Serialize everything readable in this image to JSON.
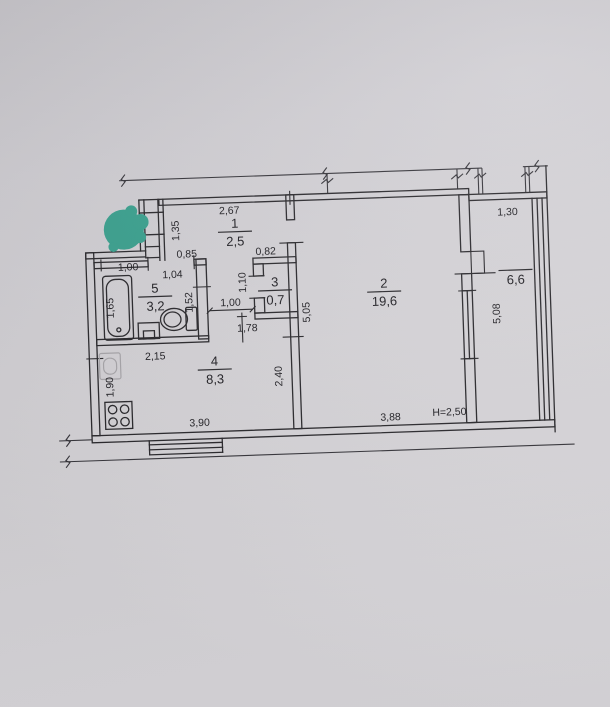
{
  "photo": {
    "background": "#d4d2d6",
    "line_color": "#29282c",
    "text_color": "#222126",
    "marker_color": "#3aa18f",
    "faint_color": "#a9a7ab"
  },
  "plan": {
    "rooms": [
      {
        "id": "hallway",
        "number": "1",
        "area": "2,5",
        "cx": 188,
        "line_y": 77
      },
      {
        "id": "living-room",
        "number": "2",
        "area": "19,6",
        "cx": 335,
        "line_y": 142
      },
      {
        "id": "wc",
        "number": "3",
        "area": "0,7",
        "cx": 226,
        "line_y": 137
      },
      {
        "id": "kitchen",
        "number": "4",
        "area": "8,3",
        "cx": 163,
        "line_y": 214
      },
      {
        "id": "bathroom",
        "number": "5",
        "area": "3,2",
        "cx": 106,
        "line_y": 139
      },
      {
        "id": "balcony",
        "number": "",
        "area": "6,6",
        "cx": 467,
        "line_y": 125,
        "overline": true
      }
    ],
    "dimensions": [
      {
        "text": "2,67",
        "x": 183,
        "y": 59
      },
      {
        "text": "1,35",
        "x": 132,
        "y": 74,
        "vertical": true
      },
      {
        "text": "0,85",
        "x": 139,
        "y": 101
      },
      {
        "text": "1,00",
        "x": 80,
        "y": 112
      },
      {
        "text": "1,04",
        "x": 124,
        "y": 121
      },
      {
        "text": "0,82",
        "x": 218,
        "y": 101
      },
      {
        "text": "1,10",
        "x": 197,
        "y": 128,
        "vertical": true
      },
      {
        "text": "1,52",
        "x": 143,
        "y": 146,
        "vertical": true
      },
      {
        "text": "1,65",
        "x": 64,
        "y": 149,
        "vertical": true
      },
      {
        "text": "1,00",
        "x": 181,
        "y": 151
      },
      {
        "text": "1,78",
        "x": 197,
        "y": 177
      },
      {
        "text": "2,15",
        "x": 104,
        "y": 202
      },
      {
        "text": "1,90",
        "x": 61,
        "y": 228,
        "vertical": true
      },
      {
        "text": "2,40",
        "x": 230,
        "y": 223,
        "vertical": true
      },
      {
        "text": "5,05",
        "x": 260,
        "y": 160,
        "vertical": true
      },
      {
        "text": "3,90",
        "x": 146,
        "y": 270
      },
      {
        "text": "3,88",
        "x": 337,
        "y": 271
      },
      {
        "text": "H=2,50",
        "x": 396,
        "y": 268
      },
      {
        "text": "1,30",
        "x": 461,
        "y": 70
      },
      {
        "text": "5,08",
        "x": 450,
        "y": 168,
        "vertical": true
      }
    ]
  }
}
